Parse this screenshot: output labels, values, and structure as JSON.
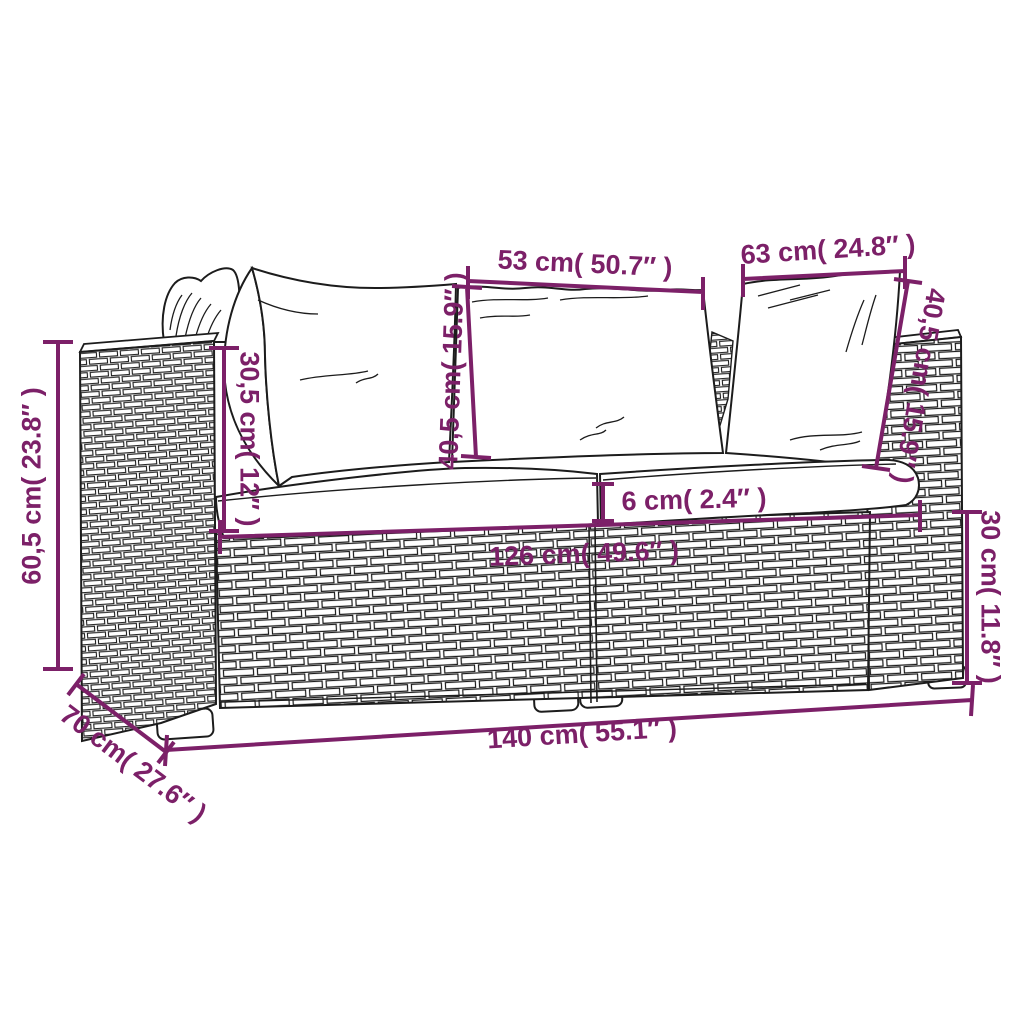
{
  "figure": {
    "colors": {
      "dimension_accent": "#7c2068",
      "line_art": "#1c1c1c",
      "background": "#ffffff"
    },
    "dimensions": {
      "middle_back_cushion_width": "53 cm( 50.7″ )",
      "corner_back_cushion_width": "63 cm( 24.8″ )",
      "back_cushion_height_middle": "40,5 cm( 15.9″ )",
      "back_cushion_height_corner": "40,5 cm( 15.9″ )",
      "armrest_height_above_seat": "30,5 cm( 12″ )",
      "overall_height": "60,5 cm( 23.8″ )",
      "seat_depth": "70 cm( 27.6″ )",
      "overall_width": "140 cm( 55.1″ )",
      "inner_seat_width": "126 cm( 49.6″ )",
      "seat_cushion_thickness": "6 cm( 2.4″ )",
      "base_height": "30 cm( 11.8″ )"
    }
  }
}
